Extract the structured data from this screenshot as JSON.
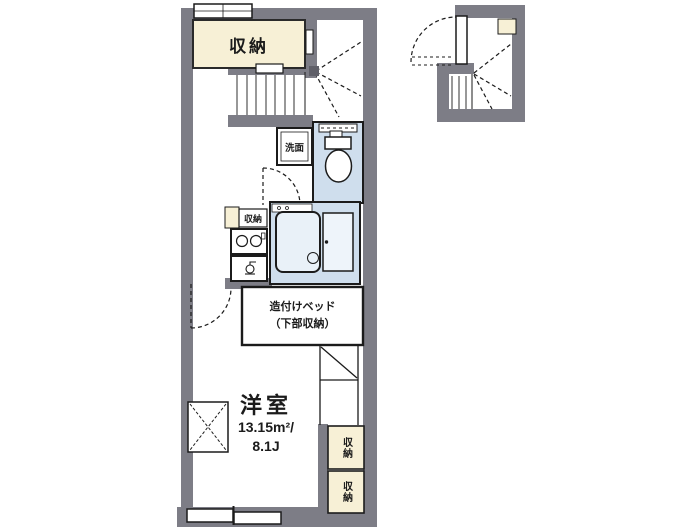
{
  "plan": {
    "type": "floor-plan",
    "colors": {
      "wall": "#7d7d86",
      "storage_fill": "#f7f0d6",
      "wet_area_fill": "#cfdeed",
      "tub_fill": "#e9f1f8",
      "line": "#1b1b1b",
      "floor": "#ffffff"
    },
    "labels": {
      "closet_top": "収納",
      "kitchen_storage": "収納",
      "washroom": "洗面",
      "bed_line1": "造付けベッド",
      "bed_line2": "（下部収納）",
      "room_name": "洋室",
      "room_area_m2": "13.15m²/",
      "room_area_jo": "8.1J",
      "closet_right_upper": "収納",
      "closet_right_lower": "収納"
    },
    "icons": [
      "stairs-straight",
      "stairs-winder",
      "toilet",
      "bathtub",
      "bath-door",
      "stove-burners",
      "kitchen-sink-faucet",
      "door-swing-arc",
      "sliding-window",
      "entrance-door",
      "shoe-storage",
      "overhead-cabinet"
    ]
  }
}
